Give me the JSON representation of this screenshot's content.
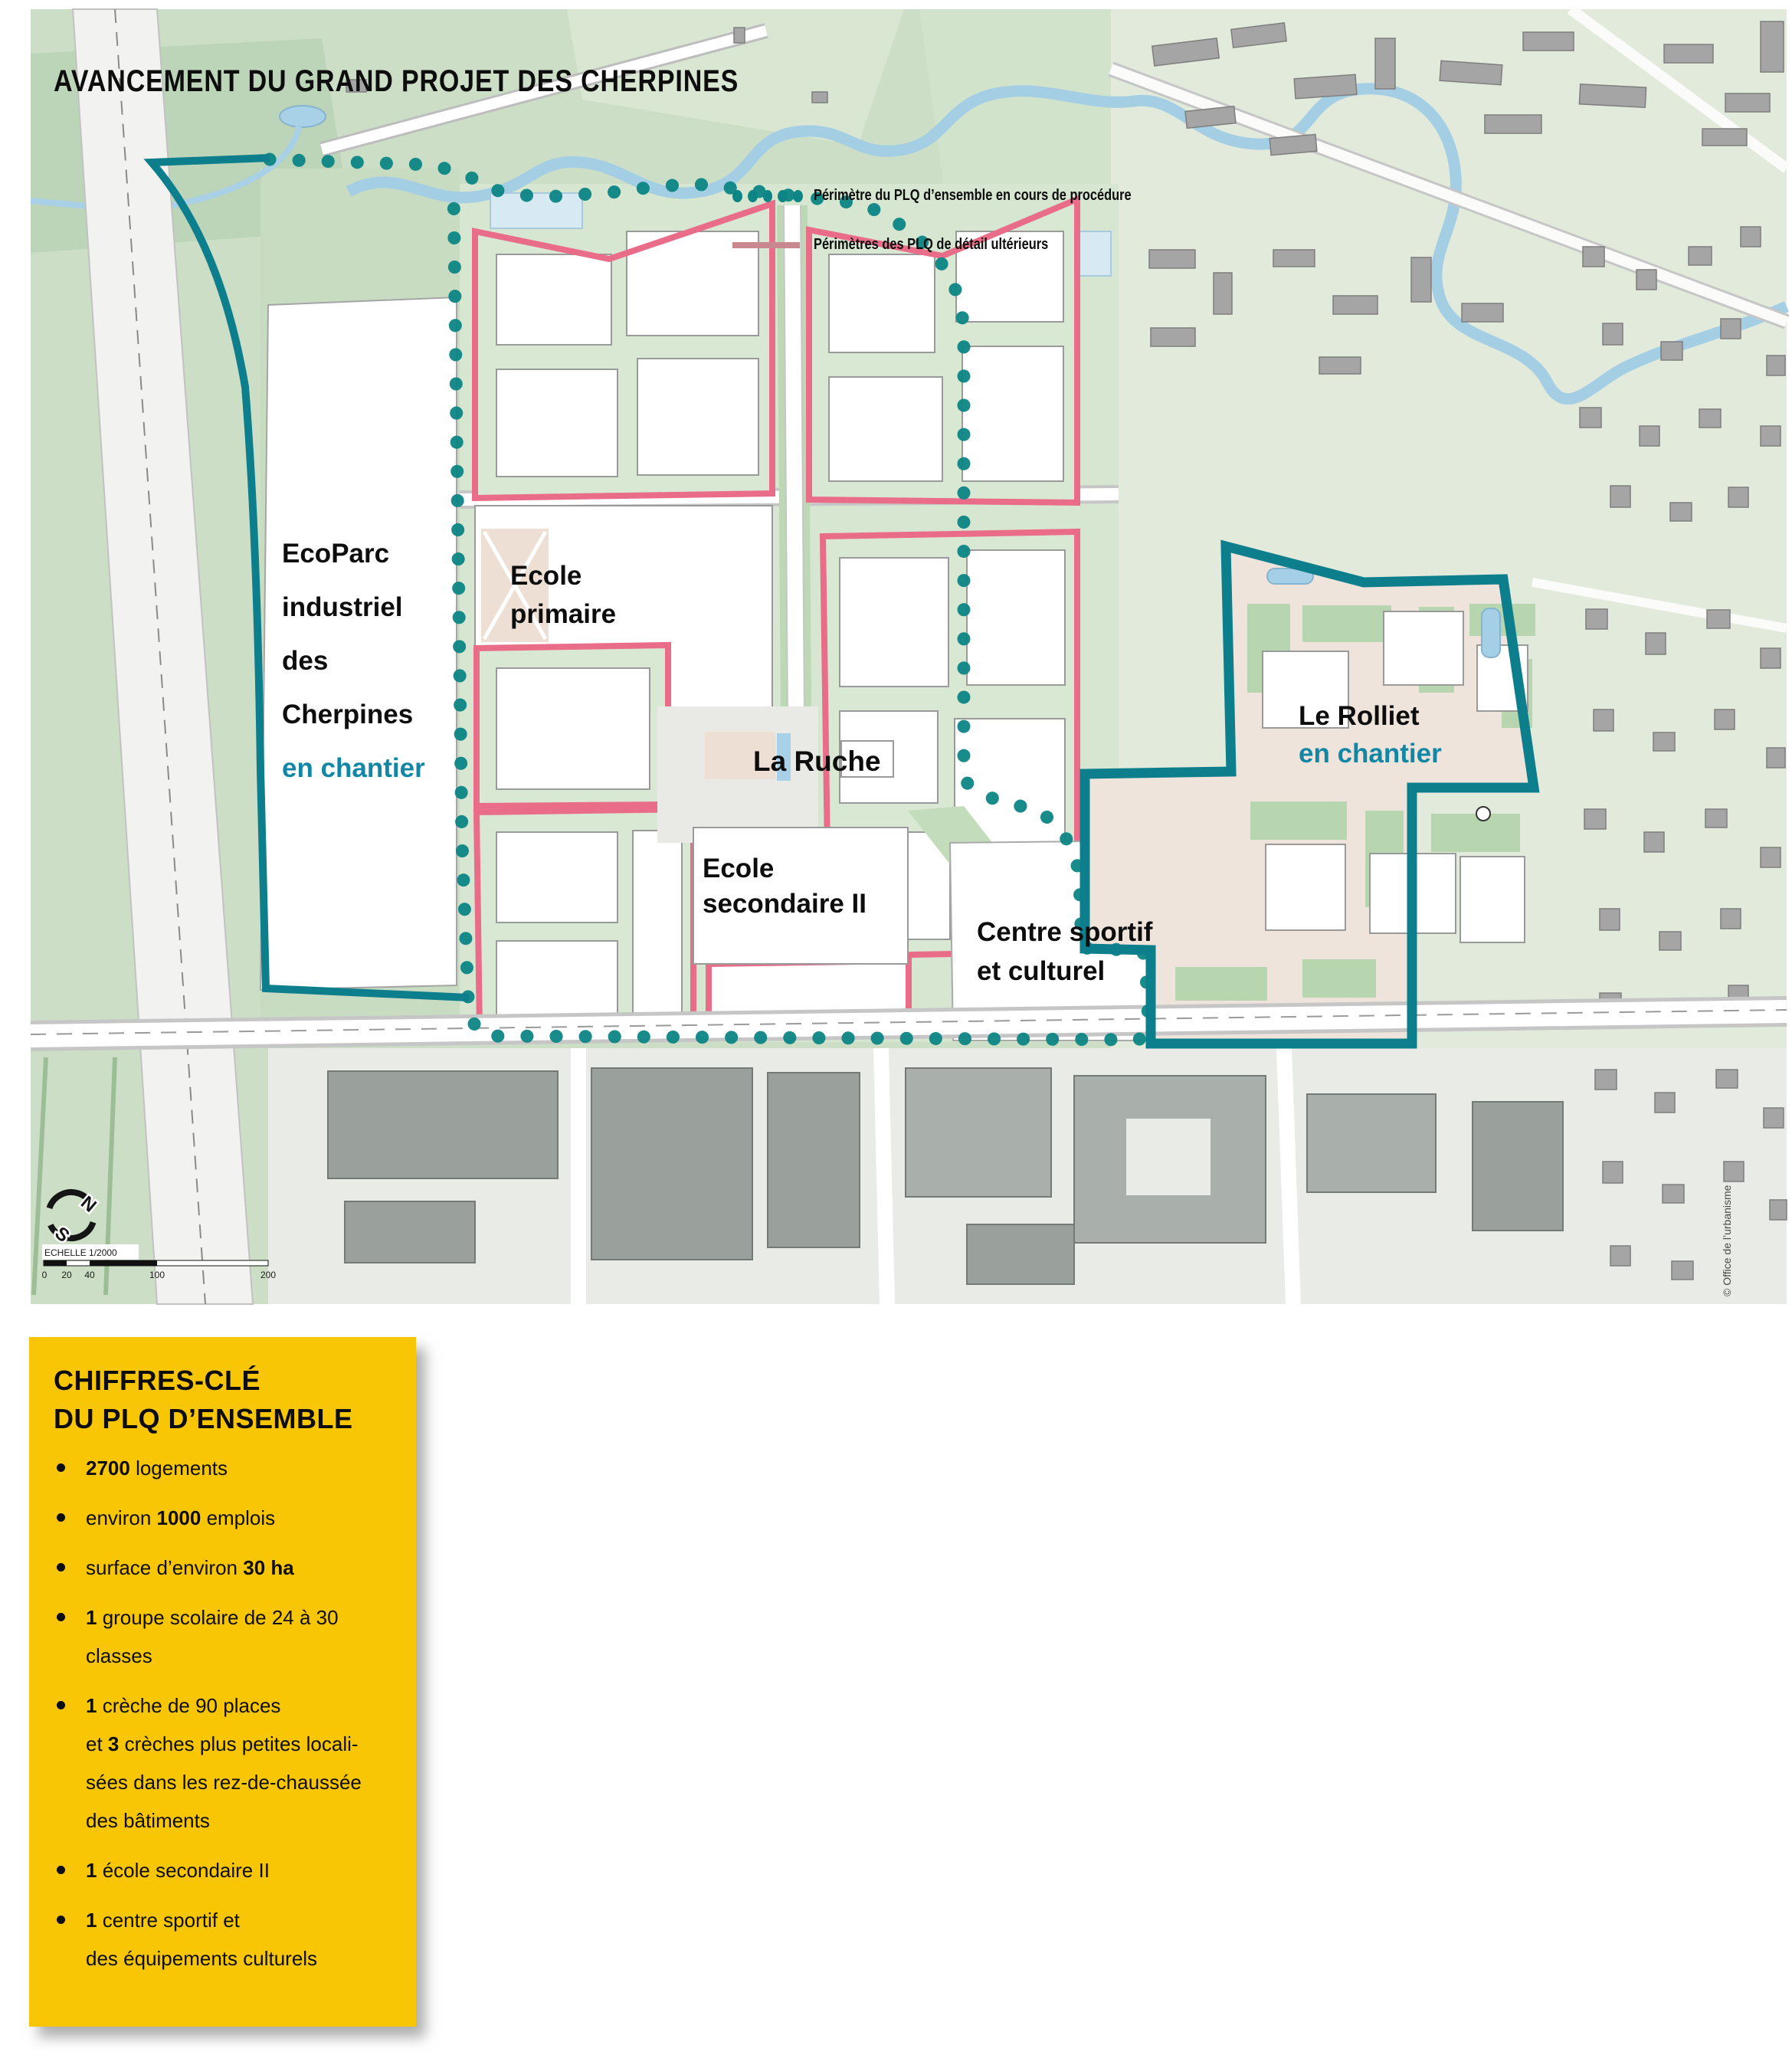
{
  "map": {
    "title": "AVANCEMENT DU GRAND PROJET DES CHERPINES",
    "legend": {
      "ensemble": "Périmètre du PLQ d’ensemble en cours de procédure",
      "detail": "Périmètres des PLQ de détail ultérieurs"
    },
    "labels": {
      "ecoparc": [
        "EcoParc",
        "industriel",
        "des",
        "Cherpines"
      ],
      "ecoparc_status": "en chantier",
      "ecole_primaire": [
        "Ecole",
        "primaire"
      ],
      "la_ruche": "La Ruche",
      "ecole_secondaire": [
        "Ecole",
        "secondaire II"
      ],
      "centre_sportif": [
        "Centre sportif",
        "et culturel"
      ],
      "rolliet": "Le Rolliet",
      "rolliet_status": "en chantier"
    },
    "compass": {
      "north": "N",
      "south": "S"
    },
    "scale": {
      "label": "ECHELLE 1/2000",
      "ticks": [
        "0",
        "20",
        "40",
        "100",
        "200"
      ]
    },
    "credit": "© Office de l’urbanisme",
    "colors": {
      "perimeter_teal_dots": "#0C8584",
      "boundary_teal": "#0D7E8C",
      "detail_pink": "#E96D89",
      "status_text_teal": "#1287A5"
    }
  },
  "infobox": {
    "title": [
      "CHIFFRES-CLÉ",
      "DU PLQ D’ENSEMBLE"
    ],
    "background": "#F9C606",
    "items": [
      {
        "segments": [
          {
            "t": "2700",
            "b": true
          },
          {
            "t": " logements",
            "b": false
          }
        ]
      },
      {
        "segments": [
          {
            "t": "environ ",
            "b": false
          },
          {
            "t": "1000",
            "b": true
          },
          {
            "t": " emplois",
            "b": false
          }
        ]
      },
      {
        "segments": [
          {
            "t": "surface d’environ ",
            "b": false
          },
          {
            "t": "30 ha",
            "b": true
          }
        ]
      },
      {
        "segments": [
          {
            "t": "1",
            "b": true
          },
          {
            "t": " groupe scolaire de 24 à 30\nclasses",
            "b": false
          }
        ]
      },
      {
        "segments": [
          {
            "t": "1",
            "b": true
          },
          {
            "t": " crèche de 90 places\net ",
            "b": false
          },
          {
            "t": "3",
            "b": true
          },
          {
            "t": " crèches plus petites locali-\nsées dans les rez-de-chaussée\ndes bâtiments",
            "b": false
          }
        ]
      },
      {
        "segments": [
          {
            "t": "1",
            "b": true
          },
          {
            "t": " école secondaire II",
            "b": false
          }
        ]
      },
      {
        "segments": [
          {
            "t": "1",
            "b": true
          },
          {
            "t": " centre sportif et\ndes équipements culturels",
            "b": false
          }
        ]
      }
    ]
  }
}
